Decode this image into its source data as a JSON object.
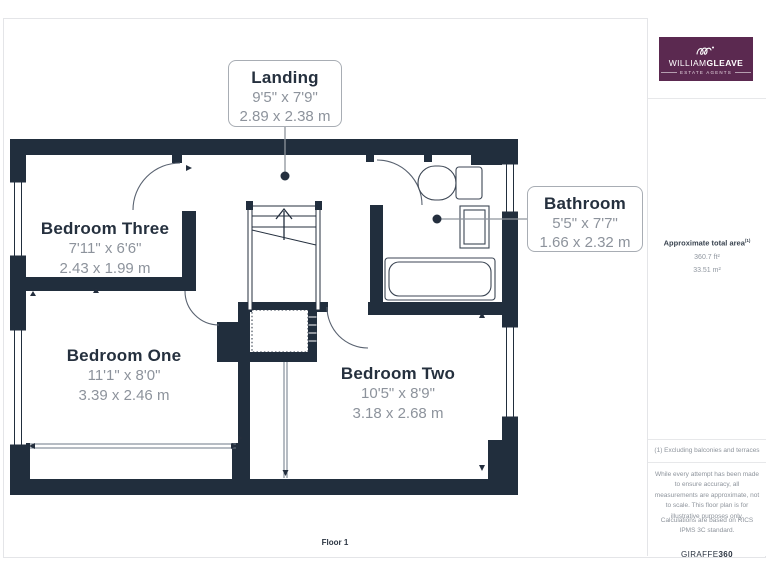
{
  "plan": {
    "floor_label": "Floor 1",
    "rooms": [
      {
        "name": "Bedroom Three",
        "imperial": "7'11\" x 6'6\"",
        "metric": "2.43 x 1.99 m"
      },
      {
        "name": "Bedroom One",
        "imperial": "11'1\" x 8'0\"",
        "metric": "3.39 x 2.46 m"
      },
      {
        "name": "Bedroom Two",
        "imperial": "10'5\" x 8'9\"",
        "metric": "3.18 x 2.68 m"
      }
    ],
    "callouts": [
      {
        "name": "Landing",
        "imperial": "9'5\" x 7'9\"",
        "metric": "2.89 x 2.38 m"
      },
      {
        "name": "Bathroom",
        "imperial": "5'5\" x 7'7\"",
        "metric": "1.66 x 2.32 m"
      }
    ]
  },
  "sidebar": {
    "logo": {
      "brand_left": "WILLIAM",
      "brand_right": "GLEAVE",
      "tagline": "ESTATE AGENTS"
    },
    "area": {
      "label": "Approximate total area",
      "superscript": "(1)",
      "ft": "360.7 ft²",
      "m": "33.51 m²"
    },
    "footnote": "(1) Excluding balconies and terraces",
    "disclaimer": "While every attempt has been made to ensure accuracy, all measurements are approximate, not to scale. This floor plan is for illustrative purposes only.",
    "standard": "Calculations are based on RICS IPMS 3C standard.",
    "credit_brand": "GIRAFFE",
    "credit_num": "360"
  },
  "colors": {
    "wall": "#212e3d",
    "dim_text": "#8d939c",
    "logo_bg": "#5b2950"
  }
}
